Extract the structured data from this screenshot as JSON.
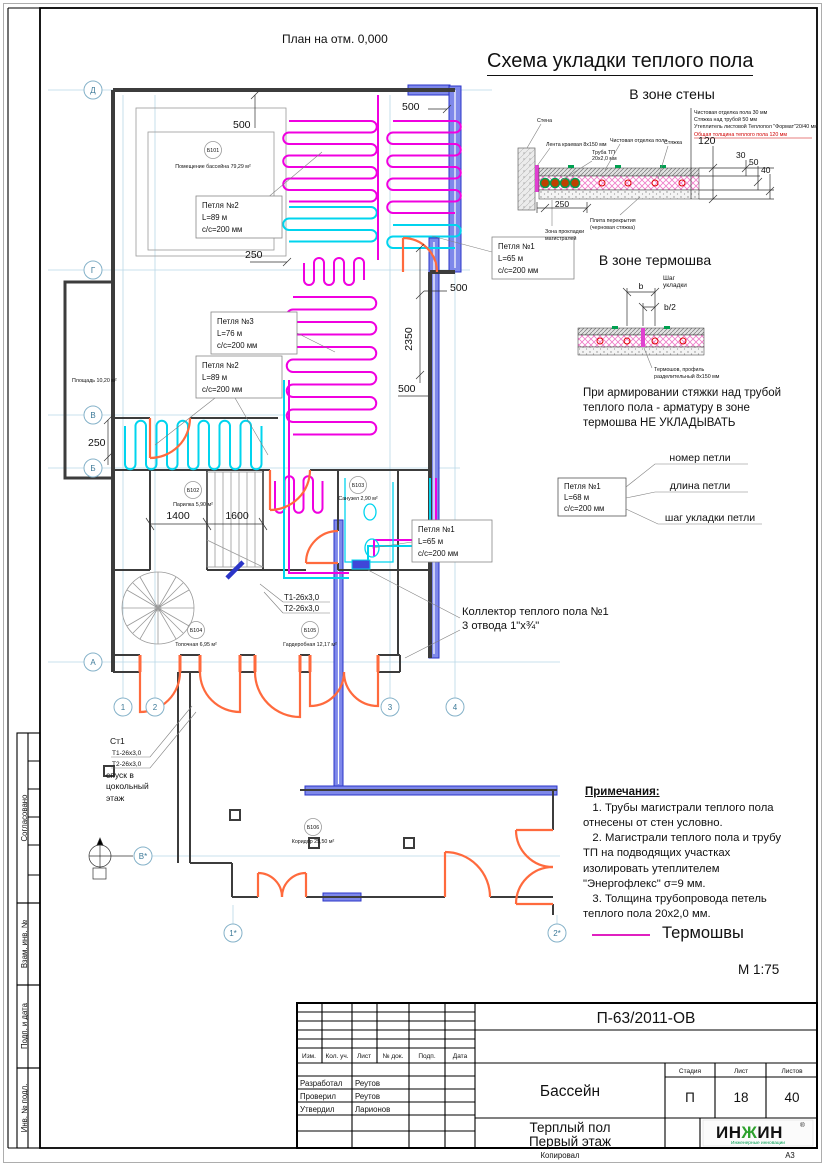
{
  "sheet": {
    "plan_title": "План на отм. 0,000",
    "scheme_title": "Схема укладки теплого пола",
    "scale": "М 1:75",
    "copied": "Копировал",
    "format": "А3"
  },
  "stamps": {
    "approved": "Согласовано",
    "vzam": "Взам. инв. №",
    "podp": "Подп. и дата",
    "inv": "Инв. № подл."
  },
  "axes": {
    "d": "Д",
    "g": "Г",
    "v": "В",
    "b": "Б",
    "a": "А",
    "v2": "В*",
    "c1": "1",
    "c2": "2",
    "c3": "3",
    "c4": "4",
    "c1s": "1*",
    "c2s": "2*"
  },
  "dims": {
    "top_left": "500",
    "top_right": "500",
    "mid_250": "250",
    "right_500a": "500",
    "right_2350": "2350",
    "right_500b": "500",
    "left_250": "250",
    "w1400": "1400",
    "w1600": "1600"
  },
  "rooms": [
    {
      "id": "Б101",
      "name": "Помещение бассейна 79,29 м²"
    },
    {
      "id": "Б102",
      "name": "Парилка 5,90 м²"
    },
    {
      "id": "Б103",
      "name": "Санузел 2,90 м²"
    },
    {
      "id": "Б104",
      "name": "Топочная 6,95 м²"
    },
    {
      "id": "Б105",
      "name": "Гардеробная 12,17 м²"
    },
    {
      "id": "Б106",
      "name": "Коридор 25,50 м²"
    }
  ],
  "area_note": "Площадь 10,20 м²",
  "loops": {
    "loop2a": {
      "name": "Петля №2",
      "len": "L=89 м",
      "step": "с/с=200 мм"
    },
    "loop3": {
      "name": "Петля №3",
      "len": "L=76 м",
      "step": "с/с=200 мм"
    },
    "loop2b": {
      "name": "Петля №2",
      "len": "L=89 м",
      "step": "с/с=200 мм"
    },
    "loop1a": {
      "name": "Петля №1",
      "len": "L=65 м",
      "step": "с/с=200 мм"
    },
    "loop1b": {
      "name": "Петля №1",
      "len": "L=65 м",
      "step": "с/с=200 мм"
    }
  },
  "riser": {
    "id": "Ст1",
    "t1": "Т1-26х3,0",
    "t2": "Т2-26х3,0",
    "note": "спуск в\nцокольный\nэтаж"
  },
  "pipes_label": {
    "t1": "Т1-26х3,0",
    "t2": "Т2-26х3,0"
  },
  "collector": {
    "line1": "Коллектор теплого пола №1",
    "line2": "3 отвода 1\"х¾\""
  },
  "wall_zone": {
    "title": "В зоне стены",
    "callouts": {
      "wall": "Стена",
      "tape": "Лента краевая 8х150 мм",
      "pipe1": "Труба ТП",
      "pipe2": "20х2,0 мм",
      "finish": "Чистовая отделка пола",
      "screed": "Стяжка",
      "slab1": "Плита перекрытия",
      "slab2": "(черновая стяжка)",
      "zone1": "Зона прокладки",
      "zone2": "магистралей"
    },
    "specs": [
      "Чистовая отделка пола 30 мм",
      "Стяжка над трубой 50 мм",
      "Утеплитель листовой Теплопол \"Формат\"20/40 мм",
      "Общая толщина теплого пола 120 мм"
    ],
    "dims": {
      "h120": "120",
      "h30": "30",
      "h50": "50",
      "h40": "40",
      "w250": "250"
    }
  },
  "seam_zone": {
    "title": "В зоне термошва",
    "dim_b": "b",
    "dim_b2": "b/2",
    "step1": "Шаг",
    "step2": "укладки",
    "seam1": "Термошов, профиль",
    "seam2": "разделительный 8х150 мм",
    "note": "При армировании стяжки над трубой\nтеплого пола - арматуру в зоне\nтермошва НЕ УКЛАДЫВАТЬ"
  },
  "legend": {
    "box": {
      "name": "Петля №1",
      "len": "L=68 м",
      "step": "с/с=200 мм"
    },
    "num": "номер петли",
    "length": "длина петли",
    "step_label": "шаг укладки петли"
  },
  "notes": {
    "title": "Примечания:",
    "body": "   1. Трубы магистрали теплого пола\nотнесены от стен условно.\n   2. Магистрали теплого пола и трубу\nТП на подводящих участках\nизолировать утеплителем\n\"Энергофлекс\" σ=9 мм.\n   3. Толщина трубопровода петель\nтеплого пола 20х2,0 мм."
  },
  "seams_legend": "Термошвы",
  "title_block": {
    "doc_number": "П-63/2011-ОВ",
    "headers": {
      "izm": "Изм.",
      "kol": "Кол. уч.",
      "list": "Лист",
      "doc": "№ док.",
      "podp": "Подп.",
      "data": "Дата"
    },
    "rows": [
      {
        "role": "Разработал",
        "name": "Реутов"
      },
      {
        "role": "Проверил",
        "name": "Реутов"
      },
      {
        "role": "Утвердил",
        "name": "Ларионов"
      }
    ],
    "object": "Бассейн",
    "stage_h": "Стадия",
    "sheet_h": "Лист",
    "sheets_h": "Листов",
    "stage": "П",
    "sheet": "18",
    "sheets": "40",
    "subject1": "Терплый пол",
    "subject2": "Первый этаж",
    "logo_p1": "ИН",
    "logo_p2": "Ж",
    "logo_p3": "ИН",
    "logo_reg": "®",
    "logo_sub": "Инженерные инновации"
  },
  "colors": {
    "loop_magenta": "#f000e0",
    "loop_cyan": "#00d4ee",
    "wall_blue": "#2b35c8",
    "door_orange": "#ff6a3d",
    "red_note": "#d00000",
    "green_mark": "#00a050"
  }
}
